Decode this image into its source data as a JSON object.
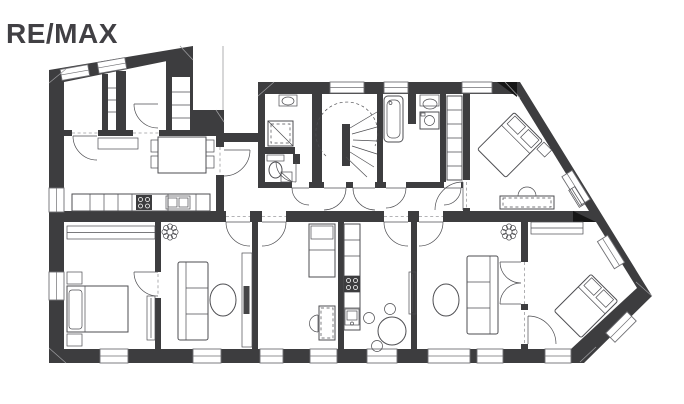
{
  "page": {
    "width": 684,
    "height": 404
  },
  "logo": {
    "text": "RE/MAX"
  },
  "palette": {
    "wall": "#3d3d3f",
    "logo": "#414044",
    "line": "#4e4e52",
    "light": "#9b9b9e",
    "floor": "#ffffff"
  },
  "floorplan": {
    "type": "apartment-floor-plan",
    "rooms": [
      {
        "id": "storage-room"
      },
      {
        "id": "hall-wardrobe-slot"
      },
      {
        "id": "entry-hall"
      },
      {
        "id": "hall-shelf-closet"
      },
      {
        "id": "kitchen-dining-west"
      },
      {
        "id": "connector-corridor"
      },
      {
        "id": "shower-wc-room"
      },
      {
        "id": "stair-hall"
      },
      {
        "id": "bathroom"
      },
      {
        "id": "built-in-closet"
      },
      {
        "id": "bedroom-northeast"
      },
      {
        "id": "corridor"
      },
      {
        "id": "bedroom-west"
      },
      {
        "id": "lounge-west"
      },
      {
        "id": "study-room"
      },
      {
        "id": "kitchen-south"
      },
      {
        "id": "living-room-east"
      },
      {
        "id": "bedroom-southeast"
      }
    ],
    "furniture": [
      "wardrobe-shelves",
      "dining-table",
      "dining-chairs",
      "sideboard",
      "kitchen-counter",
      "stove",
      "double-bowl-sink",
      "curved-staircase",
      "shower",
      "toilet",
      "washbasin",
      "corner-basin",
      "bathtub",
      "washing-machine",
      "shelf-column",
      "double-bed-diagonal",
      "nightstand",
      "desk",
      "desk-chair",
      "radiator",
      "closet-rod-wardrobe",
      "double-bed",
      "bed-pillows",
      "sofa",
      "oval-coffee-table",
      "tv-board",
      "tv",
      "potted-plant",
      "single-bed",
      "galley-counter",
      "round-dining-table",
      "stools",
      "built-in-closet",
      "double-swing-door"
    ]
  }
}
